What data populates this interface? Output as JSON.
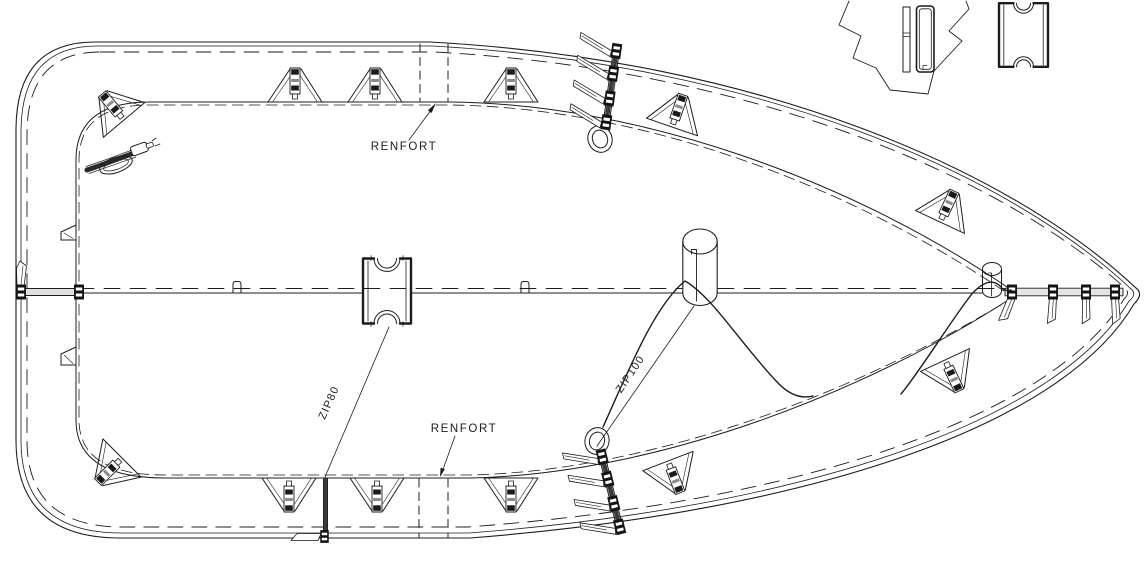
{
  "drawing": {
    "title": "boat-cover-technical-plan",
    "background": "#ffffff",
    "line_color": "#1c1c1c",
    "labels": {
      "renfort_top": "RENFORT",
      "renfort_bottom": "RENFORT",
      "zip80": "ZIP80",
      "zip100": "ZIP100"
    }
  },
  "tabs": [
    {
      "x": 124,
      "y": 120,
      "rot": -40,
      "flip": false
    },
    {
      "x": 295,
      "y": 102,
      "rot": 0,
      "flip": false
    },
    {
      "x": 375,
      "y": 102,
      "rot": 0,
      "flip": false
    },
    {
      "x": 511,
      "y": 102,
      "rot": 0,
      "flip": false
    },
    {
      "x": 672,
      "y": 127,
      "rot": 19,
      "flip": false
    },
    {
      "x": 940,
      "y": 222,
      "rot": 25,
      "flip": false
    },
    {
      "x": 122,
      "y": 458,
      "rot": 45,
      "flip": true
    },
    {
      "x": 289,
      "y": 478,
      "rot": 0,
      "flip": true
    },
    {
      "x": 377,
      "y": 478,
      "rot": 0,
      "flip": true
    },
    {
      "x": 511,
      "y": 478,
      "rot": 0,
      "flip": true
    },
    {
      "x": 668,
      "y": 461,
      "rot": -21,
      "flip": true
    },
    {
      "x": 945,
      "y": 360,
      "rot": -25,
      "flip": true
    }
  ],
  "center_loops": [
    237,
    525
  ],
  "left_strap": {
    "clamp_x": [
      21,
      79
    ]
  },
  "tip_strap": {
    "clamps": [
      {
        "x": 1012,
        "pennant_rot": 30
      },
      {
        "x": 1053,
        "pennant_rot": 12
      },
      {
        "x": 1086,
        "pennant_rot": 8
      },
      {
        "x": 1115,
        "pennant_rot": 5
      }
    ]
  },
  "zip_assemblies": [
    {
      "x": 617,
      "y": 46,
      "rot": 8,
      "loop": {
        "cx": 600,
        "cy": 139,
        "rot": -20
      }
    },
    {
      "x": 601,
      "y": 452,
      "rot": -14,
      "loop": {
        "cx": 597,
        "cy": 441,
        "rot": 15
      }
    }
  ],
  "renfort_bands": [
    {
      "x1": 420,
      "x2": 448,
      "y1": 44,
      "y2": 101
    },
    {
      "x1": 419,
      "x2": 448,
      "y1": 479,
      "y2": 537
    }
  ],
  "left_edge_tabs": [
    {
      "y1": 225,
      "y2": 240
    },
    {
      "y1": 347,
      "y2": 365
    }
  ]
}
